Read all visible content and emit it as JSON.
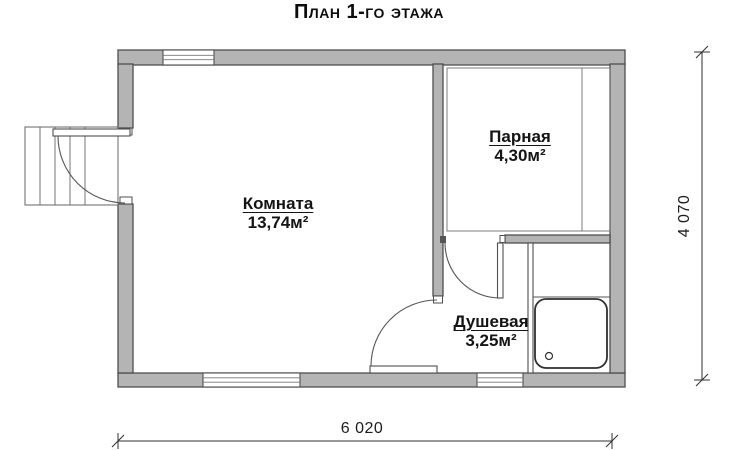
{
  "title": "План 1-го этажа",
  "rooms": {
    "komnata": {
      "name": "Комната",
      "area": "13,74м²"
    },
    "parnaya": {
      "name": "Парная",
      "area": "4,30м²"
    },
    "dushevaya": {
      "name": "Душевая",
      "area": "3,25м²"
    }
  },
  "dimensions": {
    "overall_width": "6 020",
    "overall_height": "4 070"
  },
  "colors": {
    "wall_fill": "#b4b4b4",
    "wall_outline": "#4f4f4f",
    "background": "#ffffff",
    "text": "#111111"
  }
}
